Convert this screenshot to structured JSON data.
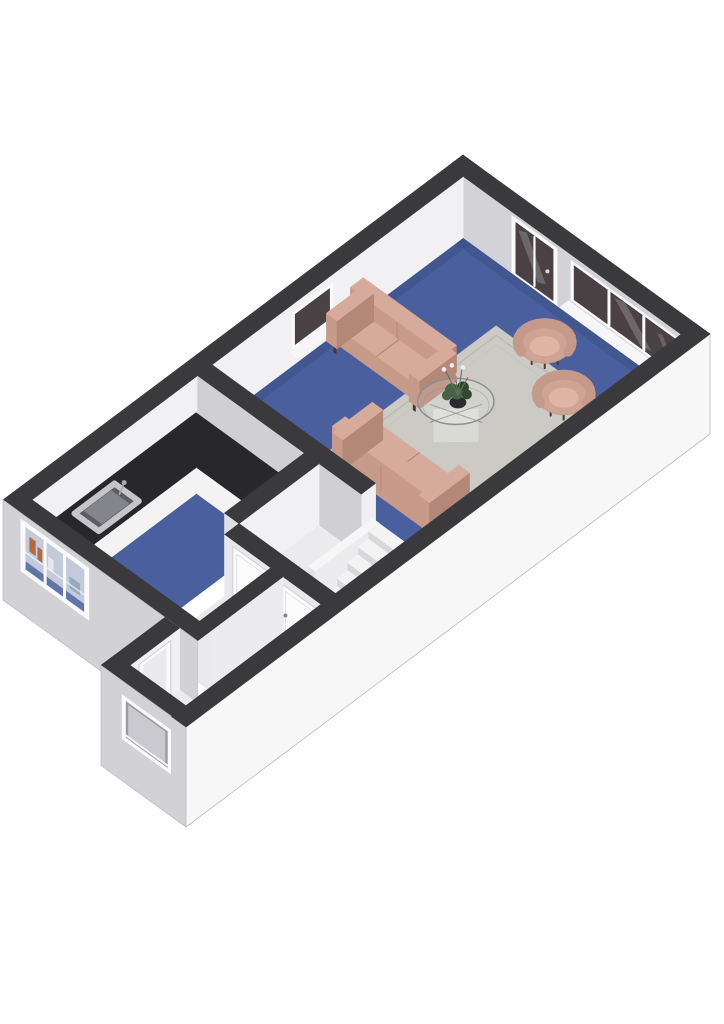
{
  "page": {
    "title": "3D Floor Plan",
    "background": "#ffffff"
  },
  "colors": {
    "wallTop": "#3a3a3c",
    "wallInnerBright": "#f1f1f3",
    "wallInnerMid": "#d3d3d7",
    "wallInnerShade": "#cfcfd4",
    "jambWhite": "#eff0f2",
    "extWhite": "#f7f7f8",
    "extGray": "#d2d2d6",
    "extStroke": "#c0c0c4",
    "floorBlue": "#4a5f9e",
    "floorBlueShade": "#3e5188",
    "floorHall": "#ebebed",
    "floorRoomSmall": "#e9e9eb",
    "rug": "#cbcac5",
    "rugBorder": "#b5b4ae",
    "rugInner": "#c2c1bc",
    "sofaTop": "#d7ab9b",
    "sofaFront": "#c89a8a",
    "sofaSide": "#b48878",
    "sofaLeg": "#4a392e",
    "chairBody": "#d0a494",
    "chairSeat": "#dfb6a6",
    "chairBack": "#c69a8a",
    "glassDark": "#4a4145",
    "frameWhite": "#fafafa",
    "sillWhite": "#f6f6f8",
    "counterTop": "#28282c",
    "counterFront": "#f3f3f4",
    "counterFrontShade": "#e4e4e8",
    "sinkSteel": "#c6c6ca",
    "sinkBasin": "#5c5c63",
    "faucet": "#a8a8ae",
    "matRed": "#8e3038",
    "matRedEdge": "#72262c",
    "stepTop": "#f3f3f4",
    "stepRiser": "#d8d8dc",
    "stairWall": "#e7e7ea",
    "doorWhite": "#fbfbfc",
    "doorEdge": "#cfcfd4",
    "doorHandle": "#85858c",
    "plantGreen": "#476244",
    "plantDark": "#31472f",
    "potDark": "#2c2c30",
    "flowerWhite": "#f0ebec",
    "flowerPink": "#e3bfc7",
    "stemGreen": "#5d7457",
    "tableStroke": "#8f8f94",
    "tableDiamond": "#e9e9e6",
    "winBlue": "#c3cbdb",
    "bottleAmber": "#b06a3d",
    "bottleWhite": "#e8e8ea",
    "shelfGray": "#8aa0b8",
    "recessShadow": "#9b9ba1",
    "recessPane": "#c9c9cf"
  },
  "scene": {
    "view": "isometric-3d",
    "rooms": [
      {
        "name": "living-room",
        "floor": "blue-carpet"
      },
      {
        "name": "kitchen",
        "floor": "blue-carpet"
      },
      {
        "name": "stair-hall",
        "floor": "light-gray"
      },
      {
        "name": "storage-room-left",
        "floor": "light-gray"
      },
      {
        "name": "storage-room-right",
        "floor": "light-gray"
      },
      {
        "name": "entrance-vestibule",
        "floor": "light-gray"
      }
    ],
    "furniture": [
      "sofa-two-seat",
      "sofa-two-seat-front",
      "armchair-left",
      "armchair-right",
      "coffee-table-glass",
      "flower-plant",
      "area-rug",
      "kitchen-counter-l-shape",
      "kitchen-sink",
      "staircase",
      "red-doormat"
    ],
    "openings": [
      "glass-door-northeast",
      "triple-window-northeast",
      "small-window-northwest",
      "kitchen-window-southwest",
      "entrance-window-southwest",
      "interior-door-hall",
      "interior-door-storage"
    ]
  }
}
